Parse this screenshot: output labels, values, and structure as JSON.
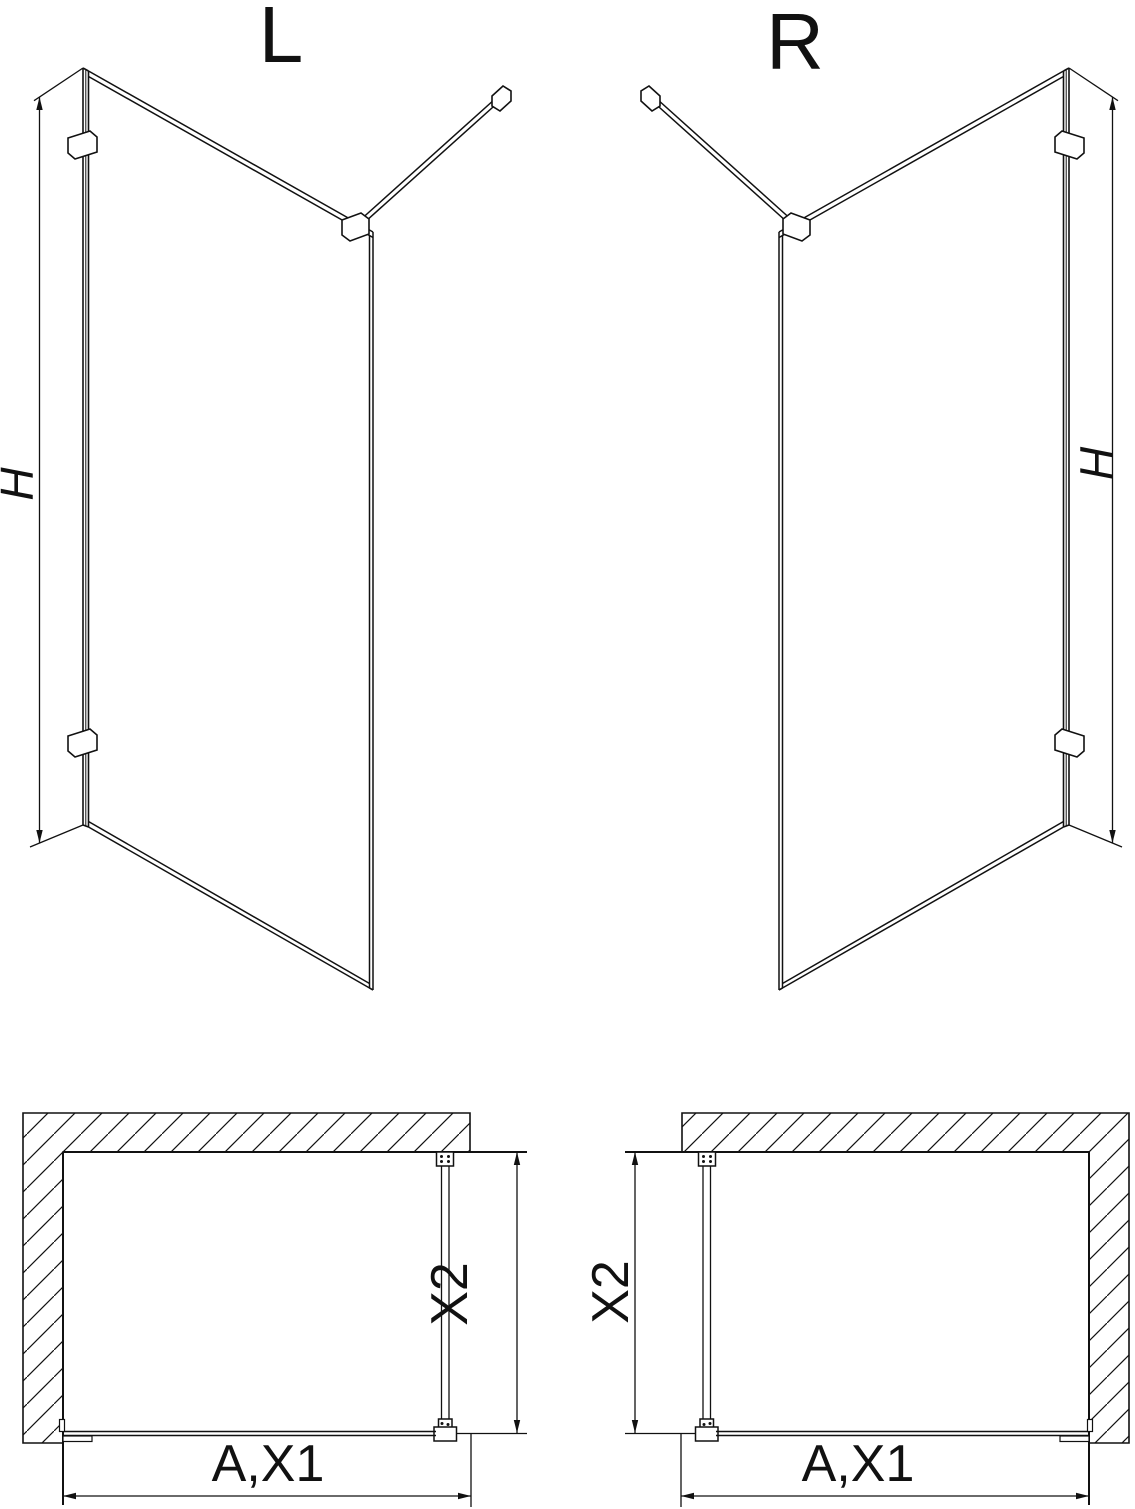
{
  "title": "Walk-in shower screen technical drawing",
  "colors": {
    "line": "#111111",
    "background": "#ffffff"
  },
  "views": {
    "perspective_left": {
      "label": "L",
      "height_dimension": "H"
    },
    "perspective_right": {
      "label": "R",
      "height_dimension": "H"
    },
    "plan_left": {
      "width_dimension": "A,X1",
      "depth_dimension": "X2"
    },
    "plan_right": {
      "width_dimension": "A,X1",
      "depth_dimension": "X2"
    }
  }
}
